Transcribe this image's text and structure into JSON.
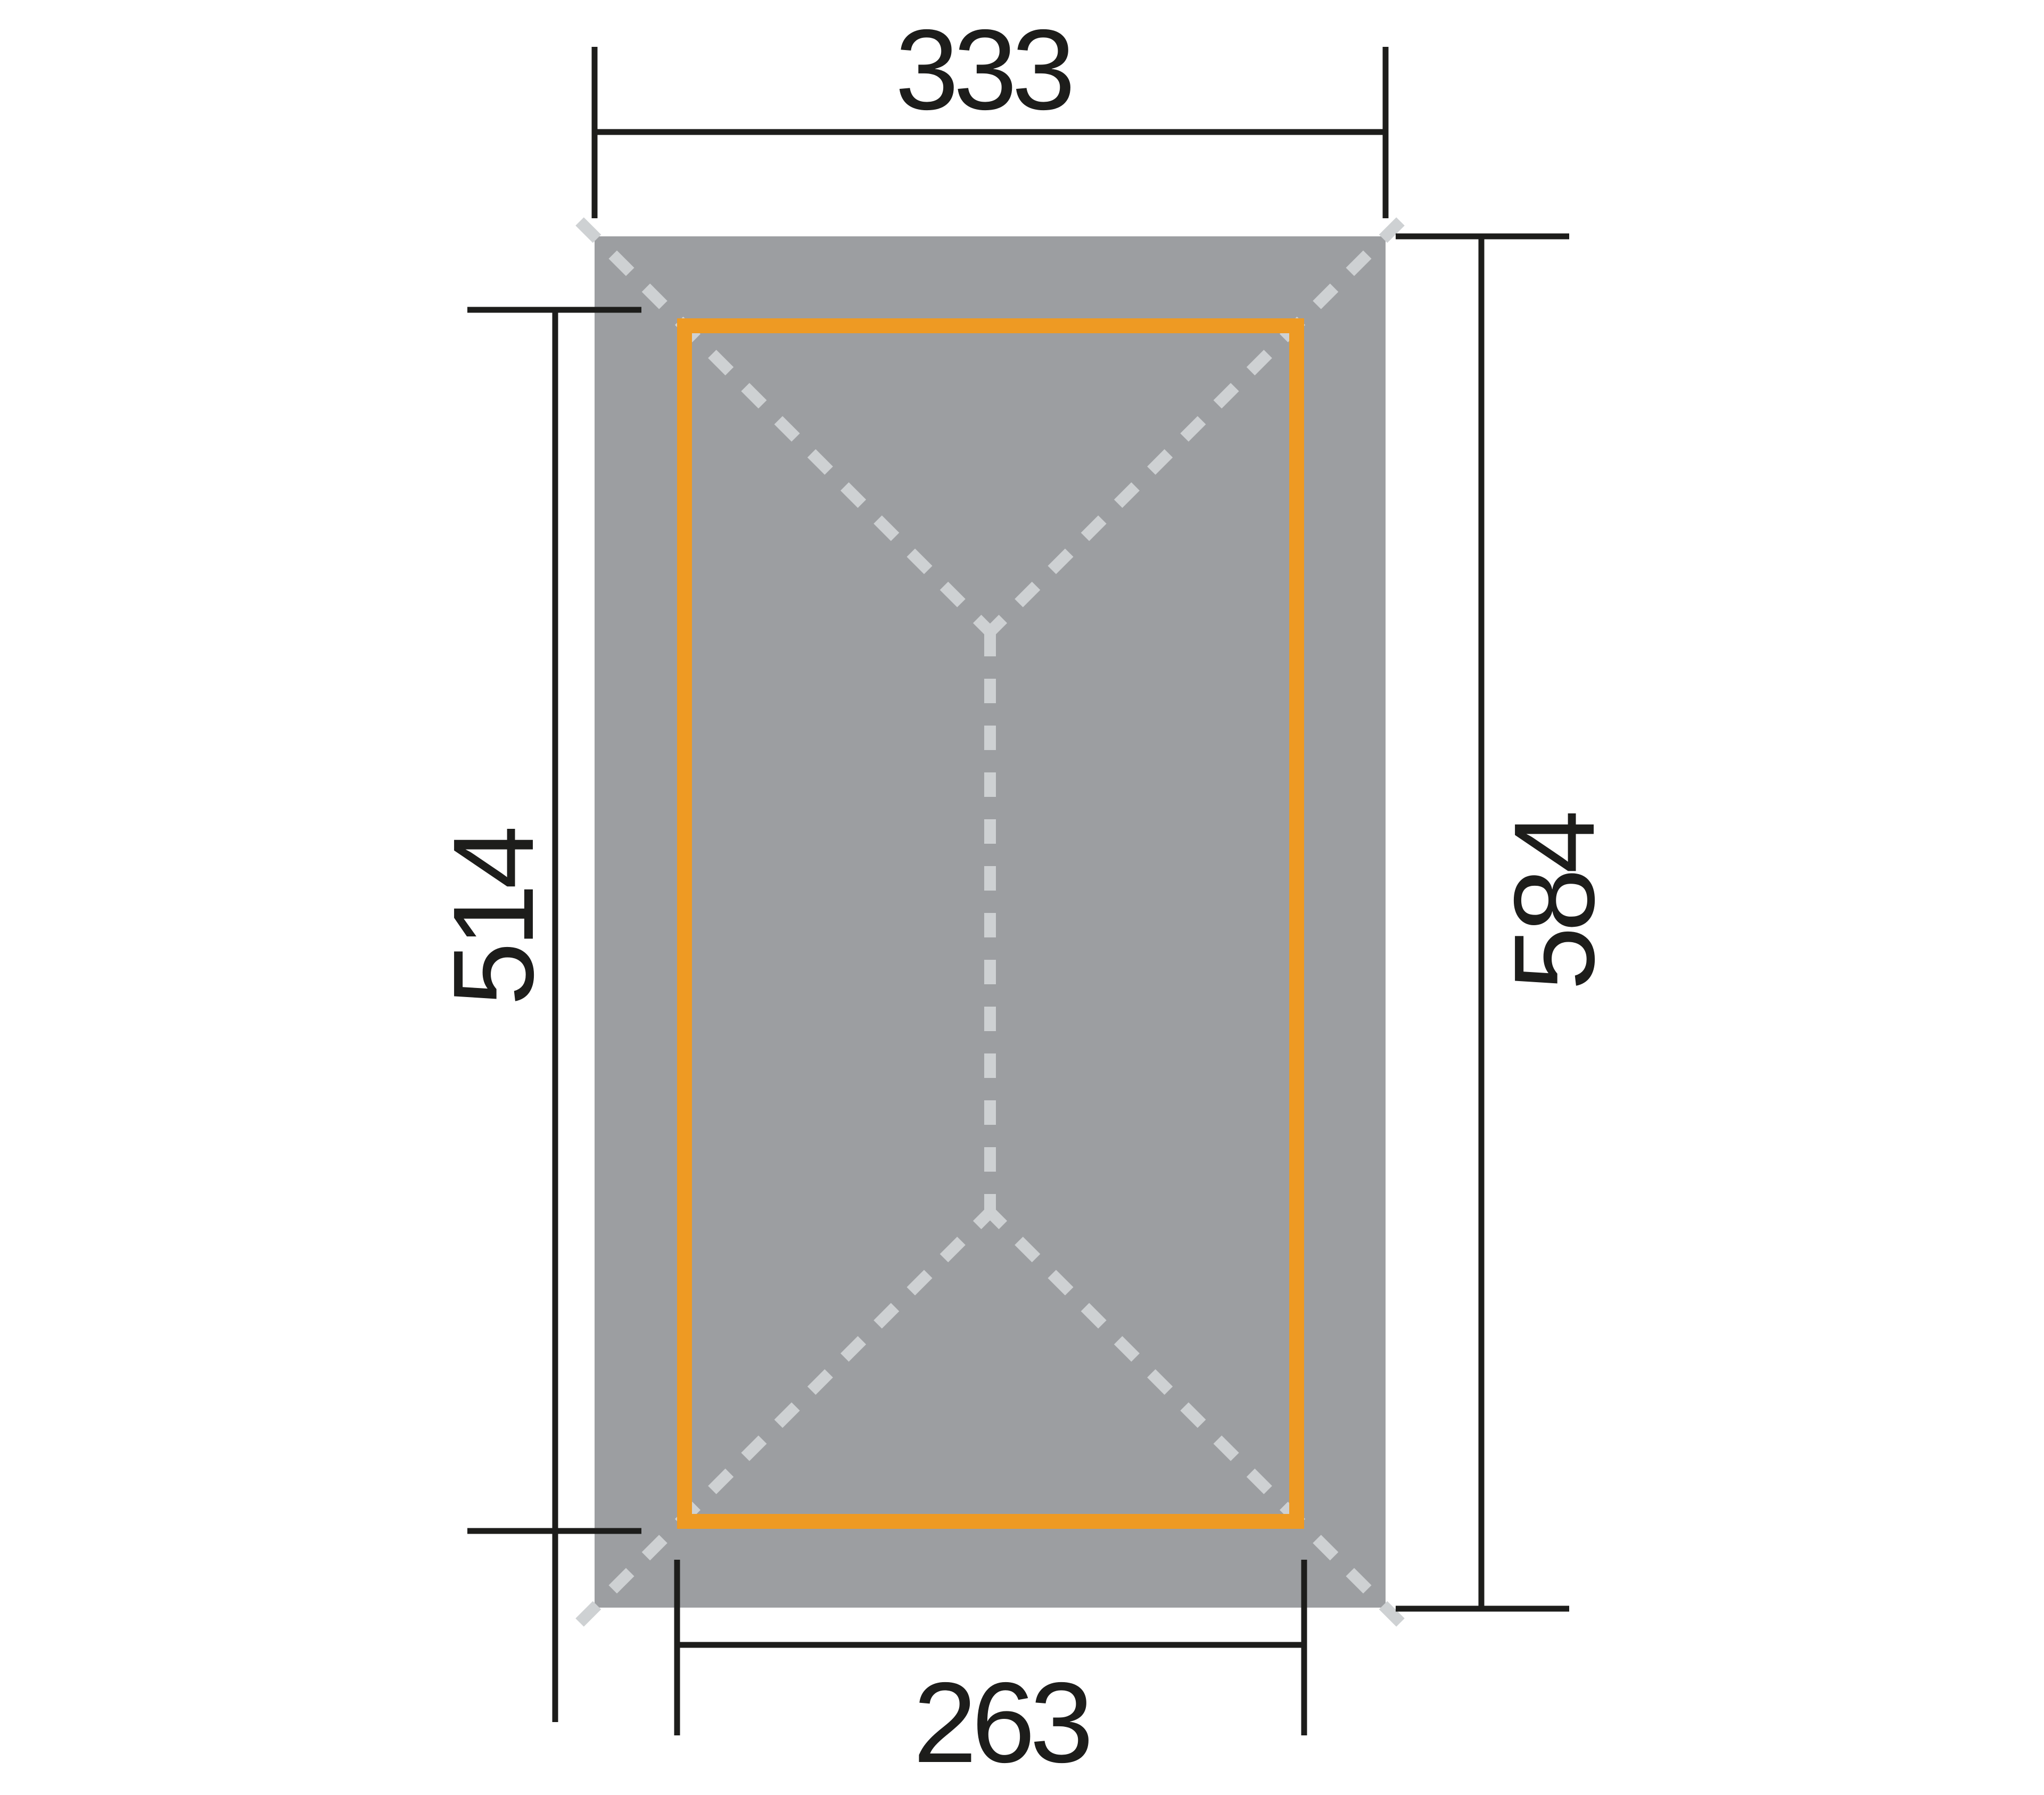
{
  "diagram": {
    "dimensions": {
      "top": "333",
      "right": "584",
      "left": "514",
      "bottom": "263"
    },
    "colors": {
      "roof_fill": "#9C9EA1",
      "roof_dash": "#CED1D3",
      "frame_stroke": "#EE9A23",
      "dimension_line": "#1D1D1B",
      "background": "#FFFFFF"
    }
  }
}
